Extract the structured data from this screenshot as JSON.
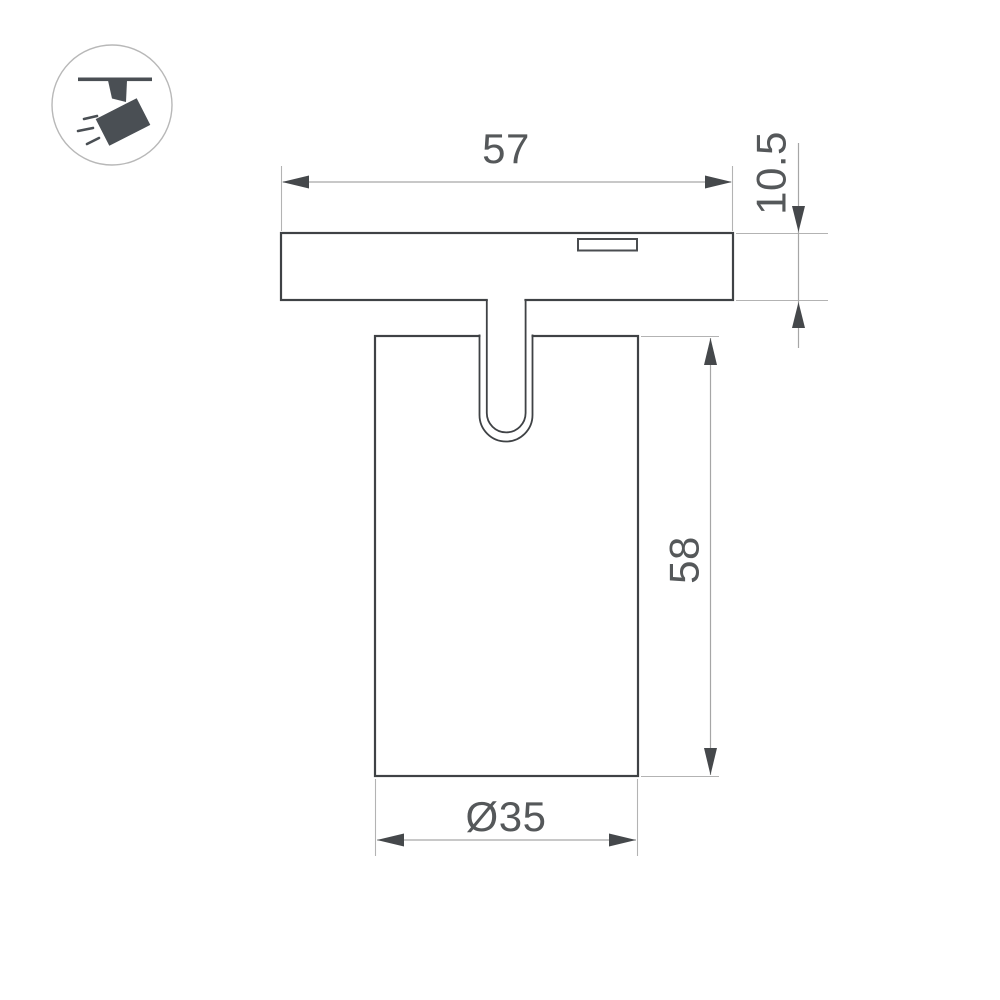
{
  "drawing": {
    "type": "technical-dimension-drawing",
    "subject": "track-mounted-spotlight",
    "dimensions": {
      "track_width": "57",
      "base_height": "10.5",
      "body_height": "58",
      "body_diameter": "Ø35"
    },
    "icon": {
      "name": "track-spotlight-icon",
      "description": "spotlight hanging from track pictogram"
    },
    "colors": {
      "background": "#ffffff",
      "outline": "#3f4245",
      "dimension_line": "#a6a6a6",
      "extension_line": "#b3b3b3",
      "arrow": "#45484b",
      "text": "#55585a",
      "icon": "#4a4f54"
    }
  }
}
